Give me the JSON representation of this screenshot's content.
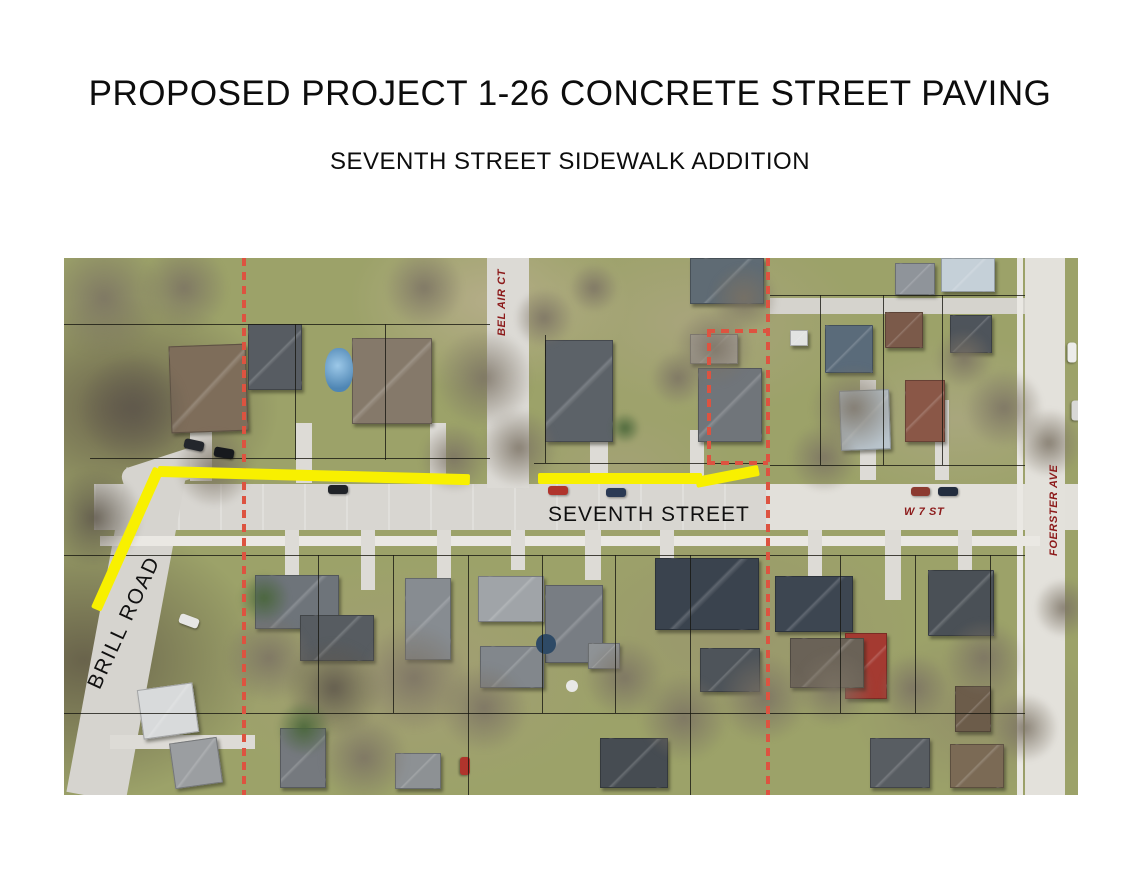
{
  "page": {
    "title": "PROPOSED PROJECT 1-26 CONCRETE STREET PAVING",
    "subtitle": "SEVENTH STREET SIDEWALK ADDITION"
  },
  "map": {
    "labels": {
      "seventh": {
        "text": "SEVENTH STREET",
        "color": "#101010"
      },
      "brill": {
        "text": "BRILL ROAD",
        "color": "#101010"
      },
      "belair": {
        "text": "BEL AIR CT",
        "color": "#8c1a1a"
      },
      "w7": {
        "text": "W 7 ST",
        "color": "#8c1a1a"
      },
      "foerster": {
        "text": "FOERSTER AVE",
        "color": "#8c1a1a"
      }
    },
    "colors": {
      "highlight": "#f8f000",
      "boundary": "#dd5340",
      "label_red": "#8c1a1a",
      "label_black": "#101010"
    }
  }
}
